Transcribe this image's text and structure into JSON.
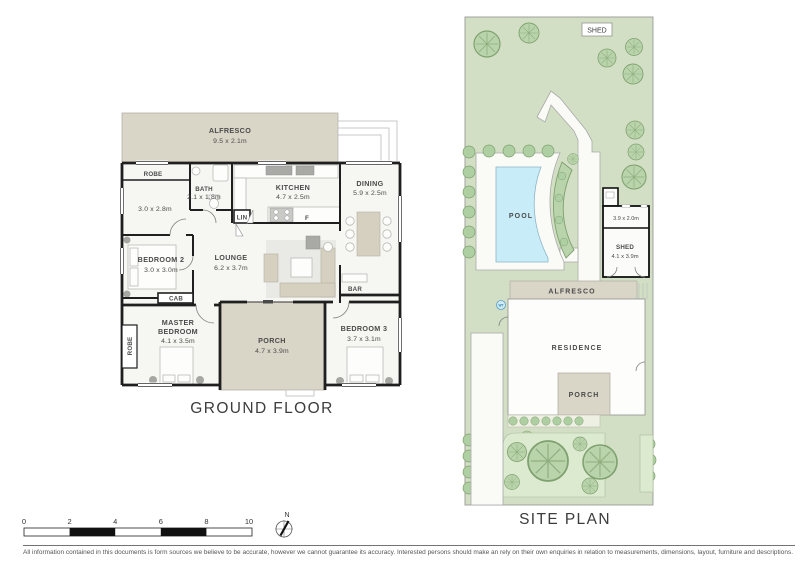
{
  "floor_plan": {
    "title": "GROUND FLOOR",
    "rooms": {
      "alfresco": {
        "name": "ALFRESCO",
        "dims": "9.5 x 2.1m"
      },
      "robe_top": {
        "name": "ROBE"
      },
      "study": {
        "dims": "3.0 x 2.8m"
      },
      "bath": {
        "name": "BATH",
        "dims": "2.1 x 1.8m"
      },
      "kitchen": {
        "name": "KITCHEN",
        "dims": "4.7 x 2.5m"
      },
      "dining": {
        "name": "DINING",
        "dims": "5.9 x 2.5m"
      },
      "lin": {
        "name": "LIN"
      },
      "fridge": {
        "name": "F"
      },
      "bedroom2": {
        "name": "BEDROOM 2",
        "dims": "3.0 x 3.0m"
      },
      "lounge": {
        "name": "LOUNGE",
        "dims": "6.2 x 3.7m"
      },
      "cab": {
        "name": "CAB"
      },
      "bar": {
        "name": "BAR"
      },
      "master": {
        "line1": "MASTER",
        "line2": "BEDROOM",
        "dims": "4.1 x 3.5m"
      },
      "robe_master": {
        "name": "ROBE"
      },
      "porch": {
        "name": "PORCH",
        "dims": "4.7 x 3.9m"
      },
      "bedroom3": {
        "name": "BEDROOM 3",
        "dims": "3.7 x 3.1m"
      }
    }
  },
  "site_plan": {
    "title": "SITE PLAN",
    "labels": {
      "garden_shed": "SHED",
      "pool": "POOL",
      "store_dims": "3.9 x 2.0m",
      "shed_name": "SHED",
      "shed_dims": "4.1 x 3.9m",
      "alfresco": "ALFRESCO",
      "residence": "RESIDENCE",
      "porch": "PORCH",
      "water_tank": "WT"
    }
  },
  "scale_bar": {
    "ticks": [
      "0",
      "2",
      "4",
      "6",
      "8",
      "10"
    ]
  },
  "compass": {
    "north": "N"
  },
  "footer": {
    "disclaimer": "All information contained in this documents is form sources we believe to be accurate, however we cannot guarantee its accuracy. Interested persons should make an rely on their own enquiries in relation to measurements, dimensions, layout, furniture and descriptions."
  },
  "colors": {
    "alfresco_beige": "#d9d5c7",
    "lawn_green": "#d2dfc4",
    "tree_green": "#b9d3ab",
    "pool_blue": "#c9edf8",
    "wall_black": "#1f1f1f"
  }
}
